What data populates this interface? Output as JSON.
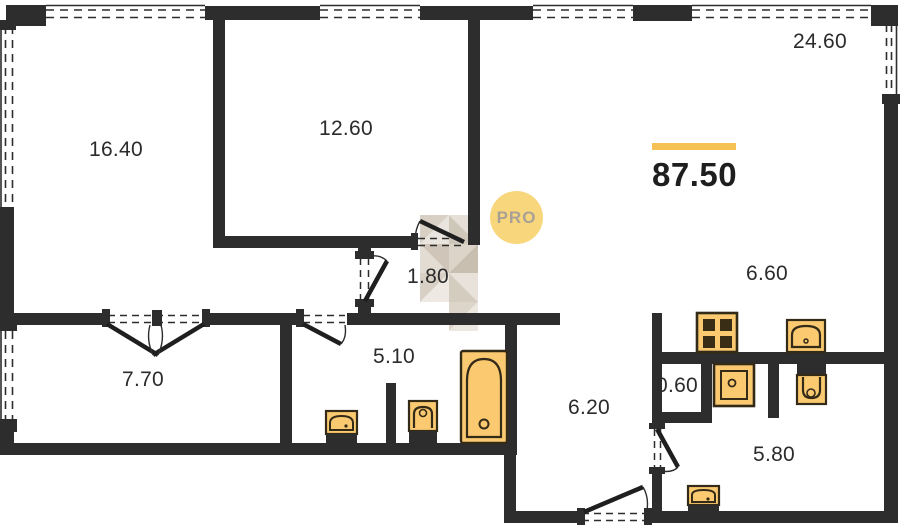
{
  "plan": {
    "badge": "PRO",
    "total_area": "87.50",
    "rooms": {
      "area_16_40": "16.40",
      "area_12_60": "12.60",
      "area_24_60": "24.60",
      "area_1_80": "1.80",
      "area_7_70": "7.70",
      "area_5_10": "5.10",
      "area_6_20": "6.20",
      "area_0_60": "0.60",
      "area_6_60": "6.60",
      "area_5_80": "5.80"
    },
    "colors": {
      "wall": "#2d2d2d",
      "accent_bar": "#f5c155",
      "fixture_fill": "#fbca70",
      "fixture_line": "#342a18",
      "badge_fill": "#f8d67c",
      "badge_text": "#a9a096",
      "watermark_tones": [
        "#d8d0c5",
        "#e9e4dd",
        "#cfc6b9",
        "#e2dcd3",
        "#c8bfb1",
        "#eee9e3"
      ]
    },
    "icons": [
      "bathtub-icon",
      "sink-icon",
      "toilet-icon",
      "stove-icon",
      "washing-machine-icon",
      "kitchen-sink-icon",
      "window-glyph",
      "door-swing-glyph",
      "watermark-mosaic"
    ]
  }
}
